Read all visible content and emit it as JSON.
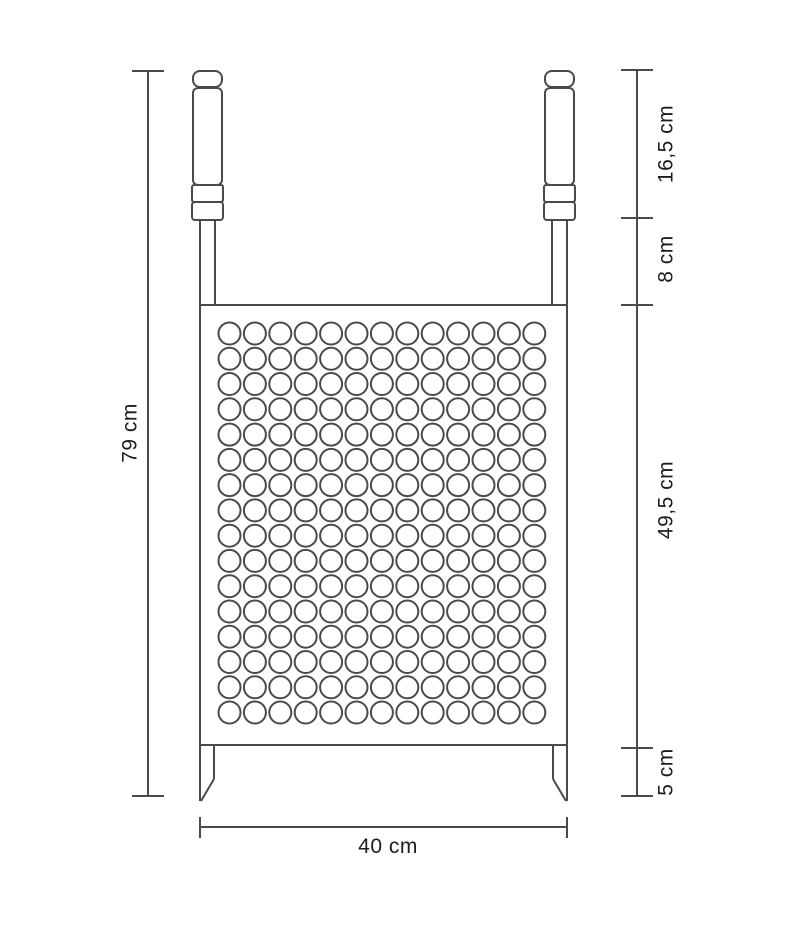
{
  "figure": {
    "type": "technical-dimension-drawing",
    "subject": "perforated grill grate with two handles and two ground spikes",
    "background": "#ffffff",
    "line_color": "#4a4a4a",
    "text_color": "#1d1d1b"
  },
  "labels": {
    "total_height": "79 cm",
    "handle_section": "16,5 cm",
    "rod_section": "8 cm",
    "grate_section": "49,5 cm",
    "leg_section": "5 cm",
    "width": "40 cm"
  },
  "holes": {
    "rows": 16,
    "cols": 13
  }
}
